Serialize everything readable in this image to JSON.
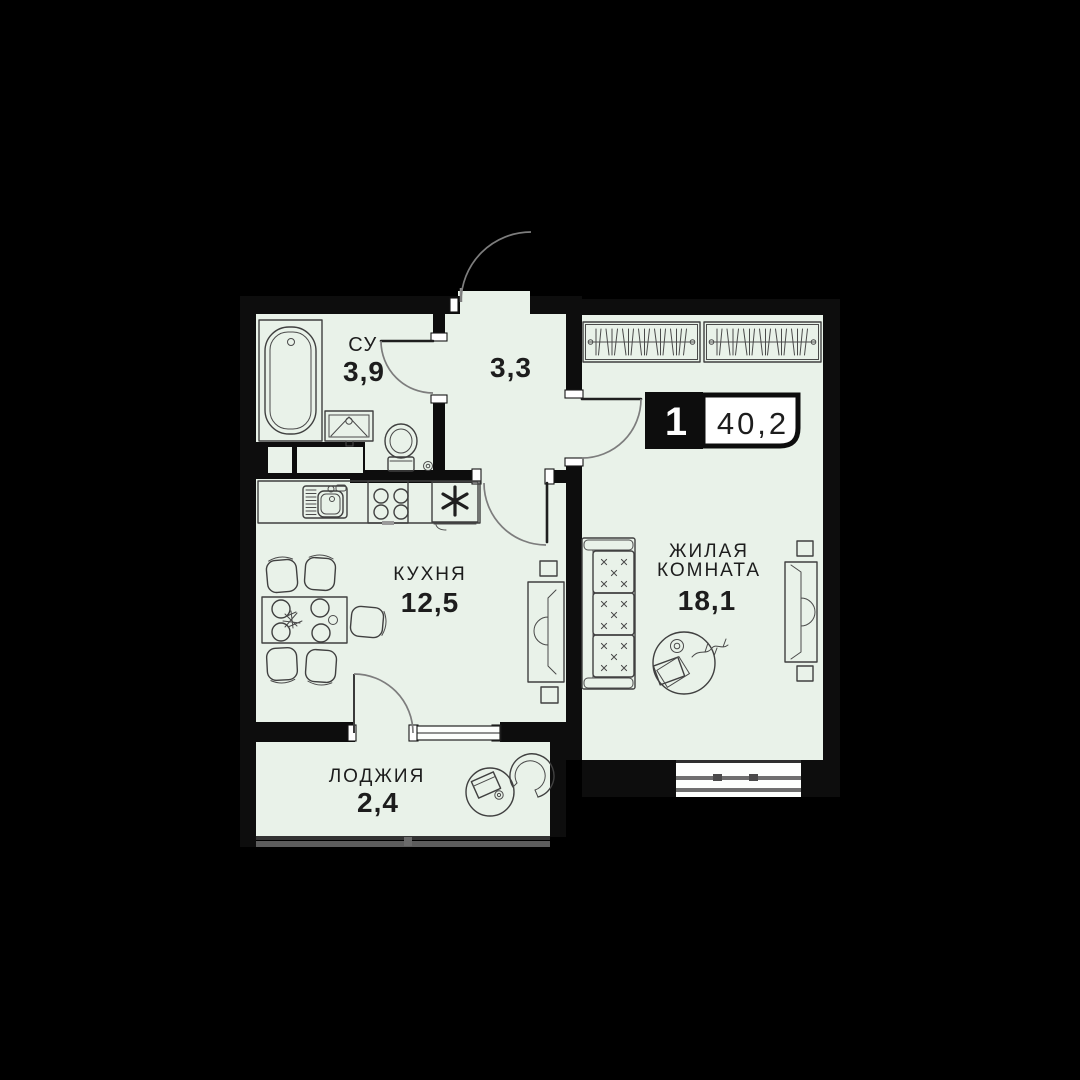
{
  "badge": {
    "rooms_count": "1",
    "total_area": "40,2"
  },
  "rooms": {
    "bathroom": {
      "label": "СУ",
      "area": "3,9"
    },
    "hallway": {
      "area": "3,3"
    },
    "kitchen": {
      "label": "КУХНЯ",
      "area": "12,5"
    },
    "living_room": {
      "label_line_1": "ЖИЛАЯ",
      "label_line_2": "КОМНАТА",
      "area": "18,1"
    },
    "loggia": {
      "label": "ЛОДЖИЯ",
      "area": "2,4"
    }
  },
  "colors": {
    "background": "#000000",
    "floor": "#e9f2e9",
    "walls": "#0d0d0d",
    "furniture_line": "#404040",
    "door_arc": "#7d7d7d",
    "glass_gray": "#6e6e6e",
    "badge_white": "#ffffff",
    "text": "#1d1d1d"
  }
}
